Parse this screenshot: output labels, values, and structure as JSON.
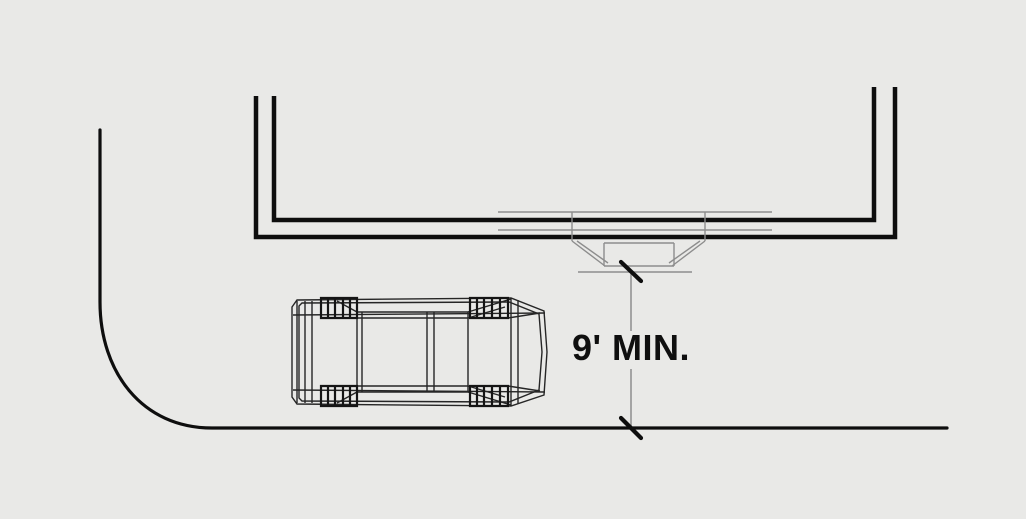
{
  "diagram": {
    "dimension_label": "9' MIN.",
    "elements": {
      "building": "building-wall-plan",
      "entry": "recessed-entry-door",
      "vehicle": "car-plan-wireframe",
      "street": "street-curb-line",
      "dimension": "vertical-dimension-line"
    }
  },
  "colors": {
    "background": "#e9e9e7",
    "ink": "#0e0e0e",
    "thin": "#8d8d8d",
    "car": "#262626",
    "label": "#0f0f0f"
  }
}
